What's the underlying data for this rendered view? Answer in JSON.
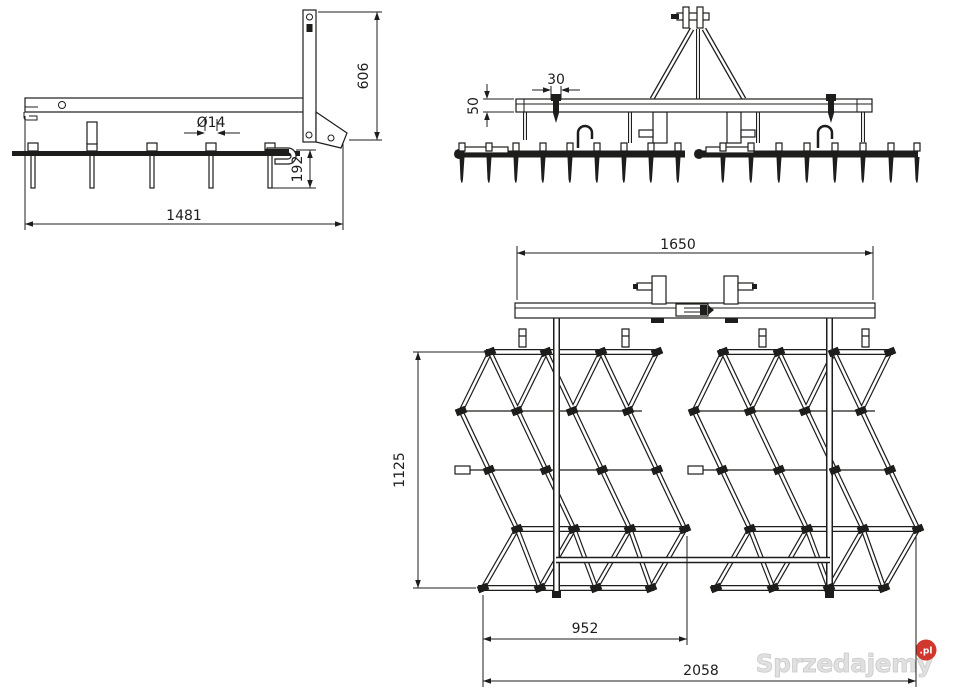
{
  "drawing_title": "Spike harrow technical drawing, three orthographic views",
  "side_view": {
    "dim_overall_width": "1481",
    "dim_frame_height": "606",
    "dim_tine_length": "192",
    "dim_tine_diameter": "Ø14"
  },
  "front_view": {
    "dim_clamp_width": "30",
    "dim_beam_height": "50"
  },
  "plan_view": {
    "dim_beam_width": "1650",
    "dim_section_depth": "1125",
    "dim_inner_width": "952",
    "dim_working_width": "2058"
  },
  "watermark": {
    "brand": "Sprzedajemy",
    "badge": ".pl"
  },
  "colors": {
    "line": "#1d1d1b",
    "background": "#ffffff",
    "watermark_text": "#e0e0e0",
    "watermark_badge": "#d0382d"
  }
}
